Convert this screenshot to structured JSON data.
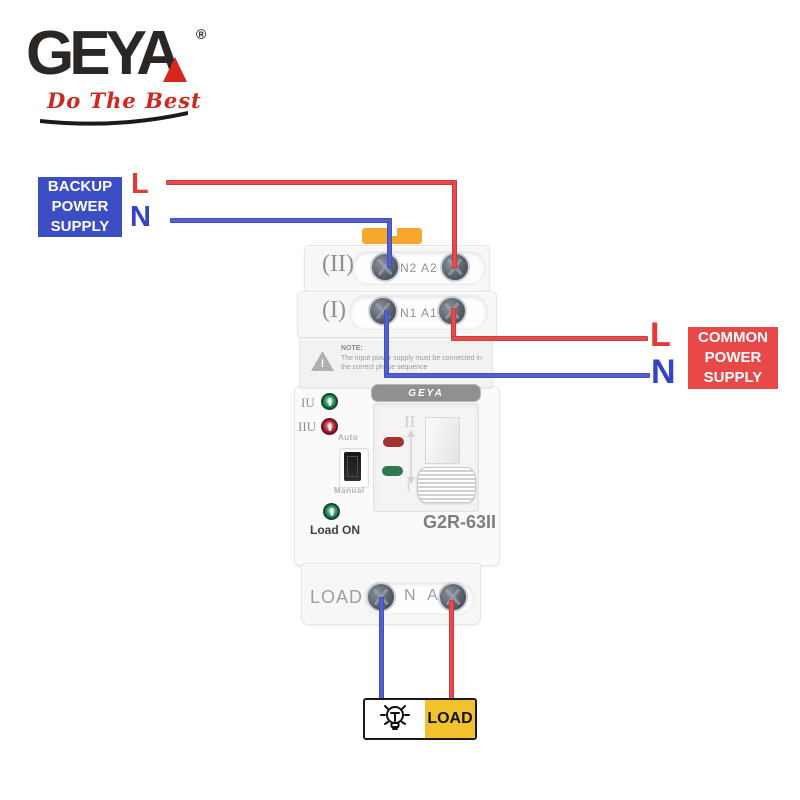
{
  "logo": {
    "brand": "GEYA",
    "registered": "®",
    "tagline": "Do The Best"
  },
  "backup": {
    "line1": "BACKUP",
    "line2": "POWER",
    "line3": "SUPPLY",
    "l": "L",
    "n": "N"
  },
  "common": {
    "line1": "COMMON",
    "line2": "POWER",
    "line3": "SUPPLY",
    "l": "L",
    "n": "N"
  },
  "device": {
    "row2_label": "(II)",
    "row2_terminals": "N2 A2",
    "row1_label": "(I)",
    "row1_terminals": "N1 A1",
    "note_title": "NOTE:",
    "note_line1": "The input power supply must be connected in",
    "note_line2": "the correct phase sequence",
    "warning_glyph": "!",
    "badge": "GEYA",
    "iu": "IU",
    "iiu": "IIU",
    "auto": "Auto",
    "manual": "Manual",
    "load_on": "Load ON",
    "panel_pos2": "II",
    "panel_pos1": "I",
    "model": "G2R-63II",
    "load_label": "LOAD",
    "load_terminals": "N A"
  },
  "load_box": {
    "label": "LOAD"
  },
  "colors": {
    "backup_blue": "#3c4ec4",
    "common_red": "#e84848",
    "wire_red": "#e9494a",
    "wire_blue": "#5160d2",
    "load_yellow": "#f2c12e",
    "brand_red": "#d8251d",
    "clip_orange": "#f6a82c"
  }
}
